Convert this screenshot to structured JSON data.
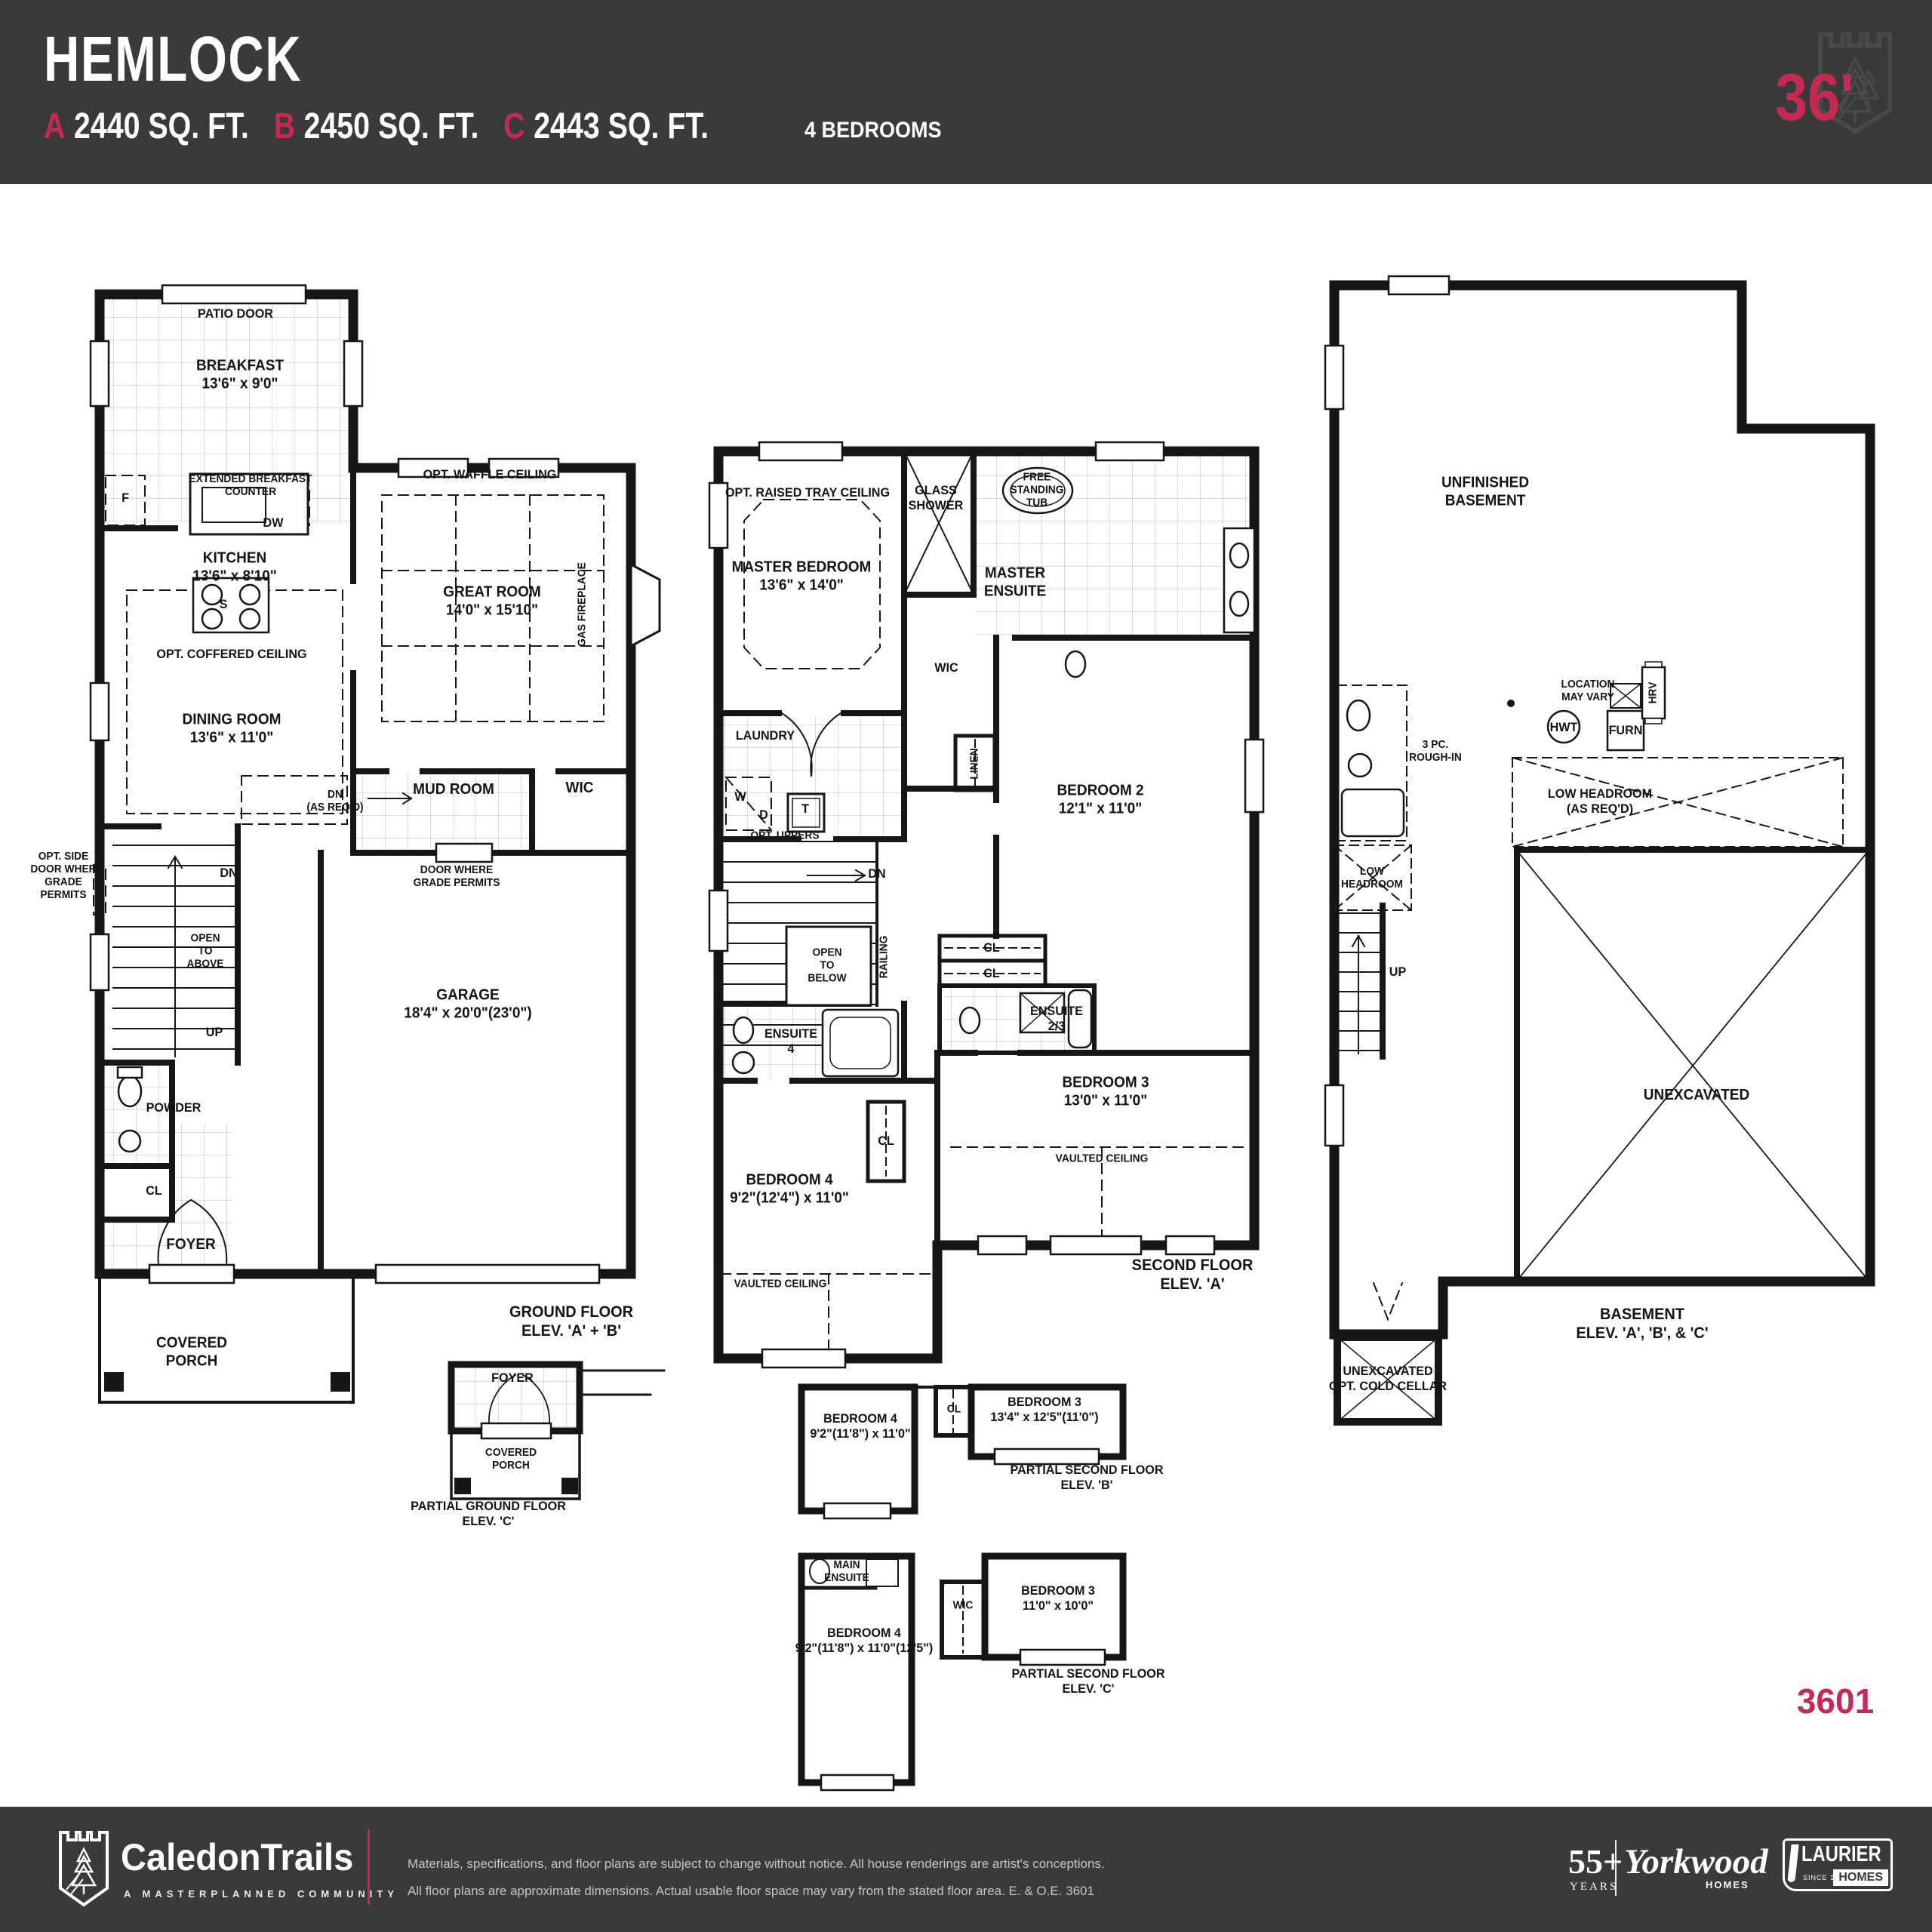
{
  "colors": {
    "accent": "#C32B53",
    "band_bg": "#3A393B",
    "plan_line": "#161616",
    "shield_gray": "#4A494C"
  },
  "header": {
    "title": "HEMLOCK",
    "variants": [
      {
        "label": "A",
        "sqft": "2440 SQ. FT."
      },
      {
        "label": "B",
        "sqft": "2450 SQ. FT."
      },
      {
        "label": "C",
        "sqft": "2443 SQ. FT."
      }
    ],
    "bedrooms": "4 BEDROOMS",
    "lot_badge": "36'"
  },
  "sheet_number": "3601",
  "ground": {
    "patio_door": "PATIO DOOR",
    "breakfast": "BREAKFAST\n13'6\" x 9'0\"",
    "ext_counter": "EXTENDED BREAKFAST\nCOUNTER",
    "fridge": "F",
    "dishwasher": "DW",
    "kitchen": "KITCHEN\n13'6\" x 8'10\"",
    "stove": "S",
    "waffle": "OPT.  WAFFLE CEILING",
    "great_room": "GREAT ROOM\n14'0\" x 15'10\"",
    "gas_fireplace": "GAS FIREPLACE",
    "coffered": "OPT. COFFERED CEILING",
    "dining": "DINING ROOM\n13'6\" x 11'0\"",
    "dn_asreqd": "DN\n(AS REQ'D)",
    "mud": "MUD ROOM",
    "wic": "WIC",
    "door_grade": "DOOR WHERE\nGRADE PERMITS",
    "side_door": "OPT. SIDE\nDOOR WHER\nGRADE\nPERMITS",
    "dn": "DN",
    "open_above": "OPEN\nTO\nABOVE",
    "up": "UP",
    "garage": "GARAGE\n18'4\" x 20'0\"(23'0\")",
    "powder": "POWDER",
    "cl": "CL",
    "foyer": "FOYER",
    "porch": "COVERED\nPORCH",
    "caption": "GROUND FLOOR\nELEV. 'A' + 'B'"
  },
  "partial_ground_c": {
    "foyer": "FOYER",
    "porch": "COVERED\nPORCH",
    "caption": "PARTIAL GROUND FLOOR\nELEV. 'C'"
  },
  "second": {
    "tray": "OPT. RAISED TRAY CEILING",
    "master": "MASTER BEDROOM\n13'6\" x 14'0\"",
    "glass_shower": "GLASS\nSHOWER",
    "tub": "FREE\nSTANDING\nTUB",
    "master_ensuite": "MASTER\nENSUITE",
    "wic": "WIC",
    "laundry": "LAUNDRY",
    "washer": "W",
    "dryer": "D",
    "opt_uppers": "OPT. UPPERS",
    "tower": "T",
    "linen": "LINEN",
    "bedroom2": "BEDROOM 2\n12'1\" x 11'0\"",
    "dn": "DN",
    "open_below": "OPEN\nTO\nBELOW",
    "railing": "RAILING",
    "cl1": "CL",
    "cl2": "CL",
    "ensuite23": "ENSUITE\n2/3",
    "ensuite4": "ENSUITE\n4",
    "bedroom3": "BEDROOM 3\n13'0\" x 11'0\"",
    "vaulted3": "VAULTED CEILING",
    "cl_hall": "CL",
    "bedroom4": "BEDROOM 4\n9'2\"(12'4\") x 11'0\"",
    "vaulted4": "VAULTED CEILING",
    "caption": "SECOND FLOOR\nELEV. 'A'"
  },
  "partial_second_b": {
    "bedroom4": "BEDROOM 4\n9'2\"(11'8\") x 11'0\"",
    "cl": "CL",
    "bedroom3": "BEDROOM 3\n13'4\" x 12'5\"(11'0\")",
    "caption": "PARTIAL SECOND FLOOR\nELEV. 'B'"
  },
  "partial_second_c": {
    "main_ensuite": "MAIN\nENSUITE",
    "bedroom4": "BEDROOM 4\n9'2\"(11'8\") x 11'0\"(12'5\")",
    "wic": "WIC",
    "bedroom3": "BEDROOM 3\n11'0\" x 10'0\"",
    "caption": "PARTIAL SECOND FLOOR\nELEV. 'C'"
  },
  "basement": {
    "unfinished": "UNFINISHED\nBASEMENT",
    "location": "LOCATION\nMAY VARY",
    "hwt": "HWT",
    "furn": "FURN",
    "hrv": "HRV",
    "rough_in": "3 PC.\nROUGH-IN",
    "low_headroom_reqd": "LOW HEADROOM\n(AS REQ'D)",
    "low_headroom": "LOW\nHEADROOM",
    "up": "UP",
    "unexcavated": "UNEXCAVATED",
    "cold_cellar": "UNEXCAVATED\nOPT. COLD CELLAR",
    "caption": "BASEMENT\nELEV. 'A', 'B', & 'C'"
  },
  "footer": {
    "community": "CaledonTrails",
    "tagline": "A MASTERPLANNED COMMUNITY",
    "disclaimer1": "Materials, specifications, and floor plans are subject to change  without notice. All house renderings are artist's conceptions.",
    "disclaimer2": "All floor plans are approximate dimensions. Actual usable floor space may vary from the stated floor area. E. & O.E.  3601",
    "years_big": "55+",
    "years_small": "YEARS",
    "builder1": "Yorkwood",
    "builder1_sub": "HOMES",
    "builder2": "LAURIER",
    "builder2_since": "SINCE 1976",
    "builder2_sub": "HOMES"
  }
}
